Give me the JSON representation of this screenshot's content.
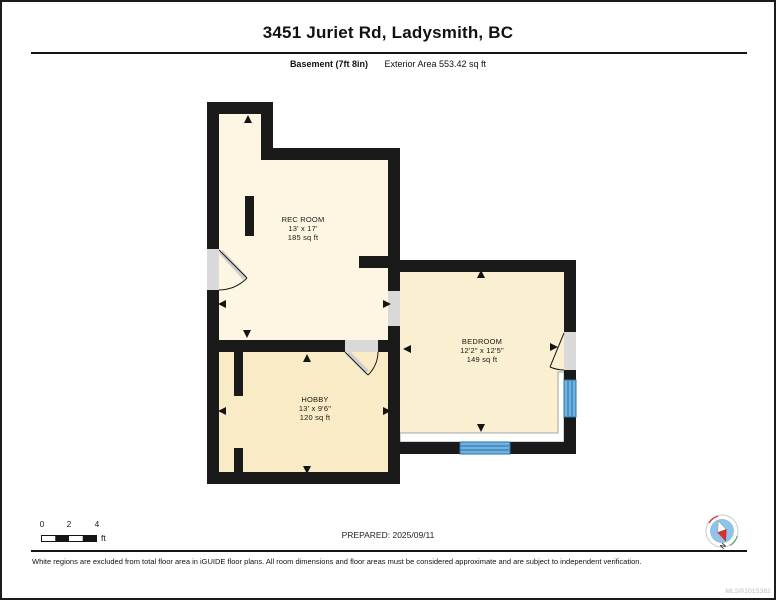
{
  "header": {
    "title": "3451 Juriet Rd, Ladysmith, BC",
    "floor_label": "Basement (7ft 8in)",
    "exterior_area": "Exterior Area 553.42 sq ft"
  },
  "rooms": [
    {
      "name": "REC ROOM",
      "dimensions": "13' x 17'",
      "area": "185 sq ft"
    },
    {
      "name": "BEDROOM",
      "dimensions": "12'2\" x 12'5\"",
      "area": "149 sq ft"
    },
    {
      "name": "HOBBY",
      "dimensions": "13' x 9'6\"",
      "area": "120 sq ft"
    }
  ],
  "scale_bar": {
    "tick_0": "0",
    "tick_2": "2",
    "tick_4": "4",
    "unit": "ft"
  },
  "compass": {
    "label": "N"
  },
  "footer": {
    "prepared": "PREPARED: 2025/09/11",
    "disclaimer": "White regions are excluded from total floor area in iGUIDE floor plans. All room dimensions and floor areas must be considered approximate and are subject to independent verification.",
    "watermark": "MLS®1015382"
  },
  "colors": {
    "wall": "#1a1a1a",
    "rec_room_fill": "#fcf6e2",
    "hobby_fill": "#f9ebc5",
    "bedroom_fill": "#faefd1",
    "door_opening_gray": "#d9d9d9",
    "window_blue": "#6fb3df",
    "window_blue_dark": "#2a6fa8",
    "excluded_region_white": "#ffffff",
    "compass_needle_red": "#d63230",
    "compass_disc_blue": "#8fc3e8"
  }
}
